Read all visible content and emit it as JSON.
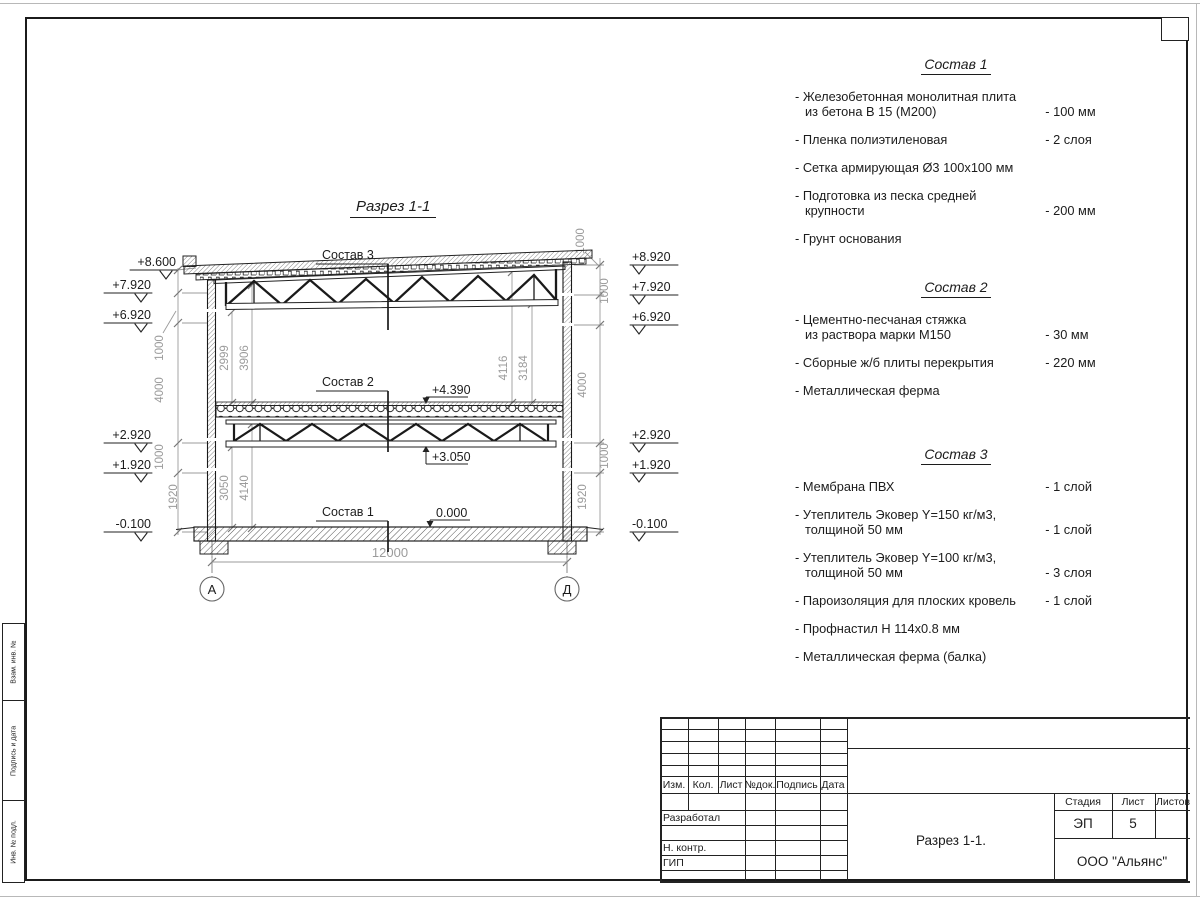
{
  "drawing_title": "Разрез 1-1",
  "compositions": [
    {
      "title": "Состав 1",
      "items": [
        {
          "name": "- Железобетонная  монолитная плита\nиз бетона В 15 (М200)",
          "value": "- 100 мм"
        },
        {
          "name": "- Пленка полиэтиленовая",
          "value": "-  2 слоя"
        },
        {
          "name": "- Сетка армирующая Ø3 100х100 мм",
          "value": ""
        },
        {
          "name": "- Подготовка из песка средней\nкрупности",
          "value": "- 200 мм"
        },
        {
          "name": "- Грунт основания",
          "value": ""
        }
      ]
    },
    {
      "title": "Состав 2",
      "items": [
        {
          "name": "- Цементно-песчаная стяжка\nиз раствора марки М150",
          "value": "- 30 мм"
        },
        {
          "name": "- Сборные ж/б плиты перекрытия",
          "value": "- 220 мм"
        },
        {
          "name": "- Металлическая ферма",
          "value": ""
        }
      ]
    },
    {
      "title": "Состав 3",
      "items": [
        {
          "name": "- Мембрана ПВХ",
          "value": "- 1 слой"
        },
        {
          "name": "- Утеплитель Эковер Y=150 кг/м3,\nтолщиной 50 мм",
          "value": "- 1 слой"
        },
        {
          "name": "- Утеплитель Эковер Y=100 кг/м3,\nтолщиной 50 мм",
          "value": "- 3 слоя"
        },
        {
          "name": "- Пароизоляция для плоских кровель",
          "value": "- 1 слой"
        },
        {
          "name": "- Профнастил Н 114х0.8 мм",
          "value": ""
        },
        {
          "name": "- Металлическая ферма (балка)",
          "value": ""
        }
      ]
    }
  ],
  "section": {
    "callouts": {
      "c1": "Состав 1",
      "c2": "Состав 2",
      "c3": "Состав 3"
    },
    "elev_left": [
      "+8.600",
      "+7.920",
      "+6.920",
      "+2.920",
      "+1.920",
      "-0.100"
    ],
    "elev_right": [
      "+8.920",
      "+7.920",
      "+6.920",
      "+2.920",
      "+1.920",
      "-0.100"
    ],
    "marks": {
      "slab": "+4.390",
      "truss": "+3.050",
      "floor": "0.000"
    },
    "dims": {
      "left": [
        "1000",
        "4000",
        "1000",
        "1920"
      ],
      "right": [
        "1000",
        "1000",
        "4000",
        "1000",
        "1920"
      ],
      "inner_left": [
        "2999",
        "3906"
      ],
      "inner_bottom": [
        "3050",
        "4140"
      ],
      "inner_right": [
        "4116",
        "3184"
      ],
      "span": "12000"
    },
    "grids": [
      "А",
      "Д"
    ]
  },
  "titleblock": {
    "headers": [
      "Изм.",
      "Кол.",
      "Лист",
      "№док.",
      "Подпись",
      "Дата"
    ],
    "roles": [
      "Разработал",
      "Н. контр.",
      "ГИП"
    ],
    "stage_label": "Стадия",
    "sheet_label": "Лист",
    "sheets_label": "Листов",
    "stage": "ЭП",
    "sheet_no": "5",
    "doc_title": "Разрез  1-1.",
    "company": "ООО \"Альянс\""
  },
  "frame_labels": [
    "Взам. инв. №",
    "Подпись и дата",
    "Инв. № подл."
  ]
}
